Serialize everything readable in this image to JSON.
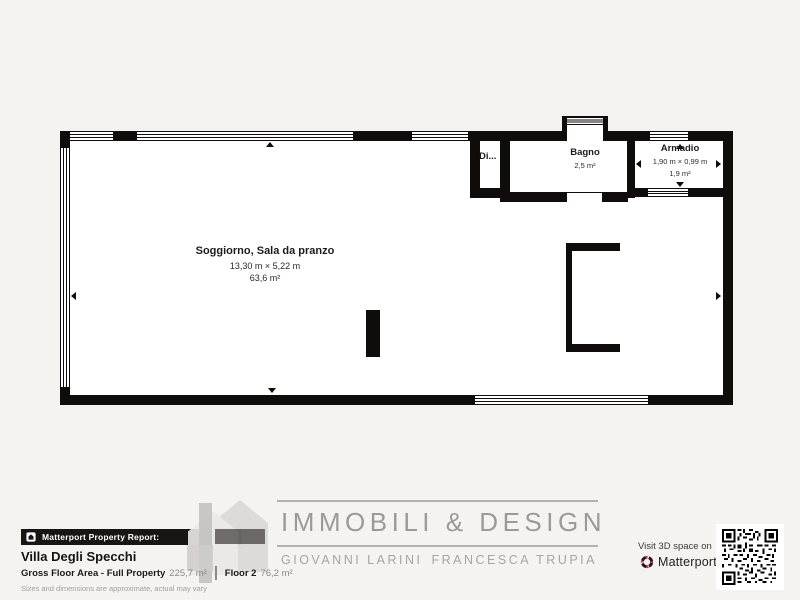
{
  "plan": {
    "soggiorno": {
      "name": "Soggiorno, Sala da pranzo",
      "dims": "13,30 m × 5,22 m",
      "area": "63,6 m²"
    },
    "bagno": {
      "name": "Bagno",
      "area": "2,5 m²"
    },
    "armadio": {
      "name": "Armadio",
      "dims": "1,90 m × 0,99 m",
      "area": "1,9 m²"
    },
    "disimpegno": {
      "name": "Di..."
    }
  },
  "footer": {
    "report_bar_label": "Matterport Property Report:",
    "property_name": "Villa Degli Specchi",
    "gross_area_label": "Gross Floor Area - Full Property",
    "gross_area_value": "225,7 m²",
    "floor_label": "Floor 2",
    "floor_value": "76,2 m²",
    "disclaimer": "Sizes and dimensions are approximate, actual may vary",
    "brand_title": "IMMOBILI & DESIGN",
    "agent_1": "GIOVANNI LARINI",
    "agent_2": "FRANCESCA TRUPIA",
    "visit_label": "Visit 3D space on",
    "matterport_wordmark": "Matterport"
  },
  "colors": {
    "background": "#f4f3f0",
    "wall": "#0e0d0c",
    "room_fill": "#ffffff",
    "brand_gray": "#9b9a98",
    "matterport_pink": "#ee2a63",
    "bar_black": "#171614"
  }
}
